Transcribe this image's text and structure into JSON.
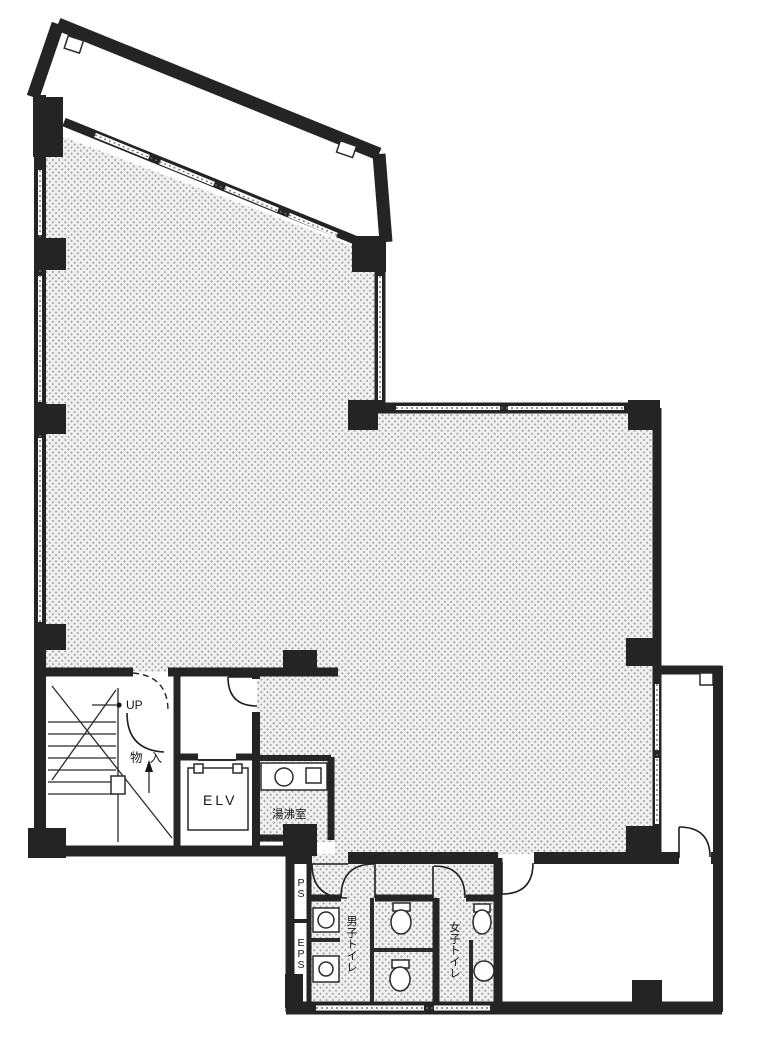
{
  "plan": {
    "title": "office-floor-plan",
    "labels": {
      "stairs_up": "UP",
      "closet": "物入",
      "elevator": "ELV",
      "kitchenette": "湯沸室",
      "pipe_shaft": "PS",
      "electrical_pipe_shaft": "EPS",
      "mens_toilet": "男子トイレ",
      "womens_toilet": "女子トイレ"
    },
    "colors": {
      "wall": "#242424",
      "floor_hatch_dot": "#a8a8a8",
      "floor_hatch_bg": "#f1f1f1",
      "room_white": "#ffffff"
    }
  }
}
